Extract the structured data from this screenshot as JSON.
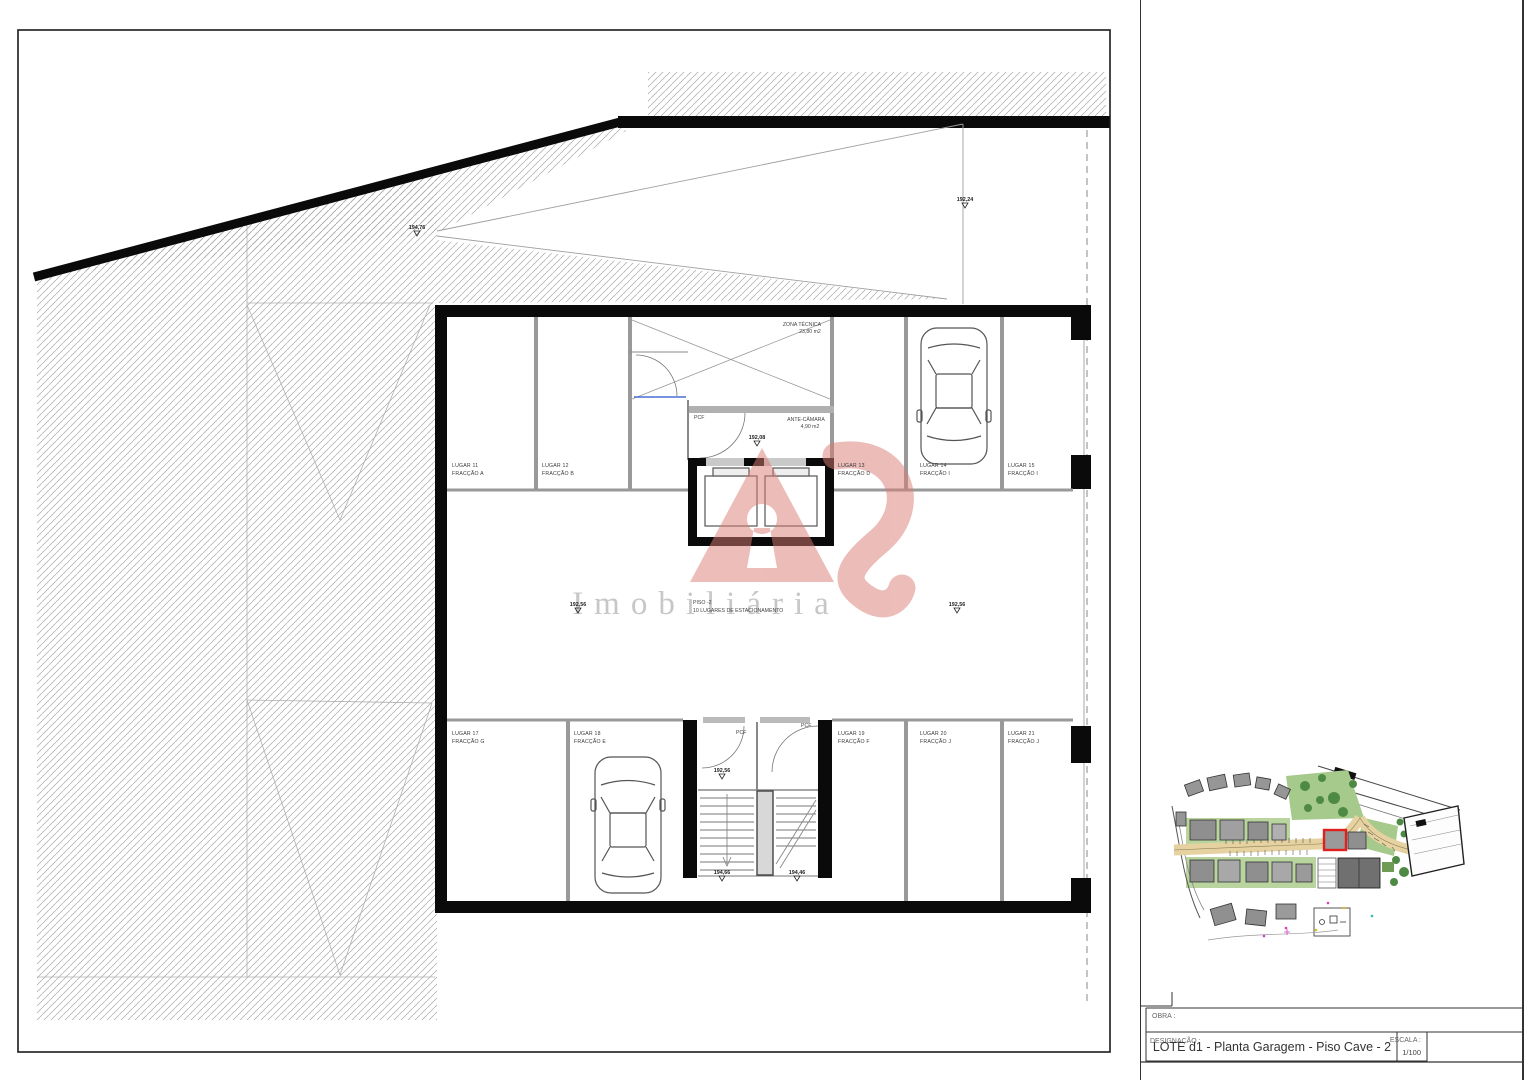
{
  "watermark": {
    "brand": "Imobiliária"
  },
  "plan": {
    "rooms": {
      "zona_tecnica_name": "ZONA TÉCNICA",
      "zona_tecnica_area": "23,80 m2",
      "ante_camara_name": "ANTE-CÂMARA",
      "ante_camara_area": "4,90 m2",
      "piso_label": "PISO -2",
      "piso_sublabel": "10 LUGARES DE ESTACIONAMENTO",
      "door_label": "PCF"
    },
    "stalls_top": [
      {
        "lugar": "LUGAR 11",
        "fraccao": "FRACÇÃO A"
      },
      {
        "lugar": "LUGAR 12",
        "fraccao": "FRACÇÃO B"
      },
      {
        "lugar": "LUGAR 13",
        "fraccao": "FRACÇÃO D"
      },
      {
        "lugar": "LUGAR 14",
        "fraccao": "FRACÇÃO I"
      },
      {
        "lugar": "LUGAR 15",
        "fraccao": "FRACÇÃO I"
      }
    ],
    "stalls_bottom": [
      {
        "lugar": "LUGAR 17",
        "fraccao": "FRACÇÃO G"
      },
      {
        "lugar": "LUGAR 18",
        "fraccao": "FRACÇÃO E"
      },
      {
        "lugar": "LUGAR 19",
        "fraccao": "FRACÇÃO F"
      },
      {
        "lugar": "LUGAR 20",
        "fraccao": "FRACÇÃO J"
      },
      {
        "lugar": "LUGAR 21",
        "fraccao": "FRACÇÃO J"
      }
    ],
    "levels": [
      {
        "id": "ramp-upper-left",
        "value": "194,76"
      },
      {
        "id": "ramp-upper-right",
        "value": "192,24"
      },
      {
        "id": "elevator-lobby",
        "value": "192,08"
      },
      {
        "id": "aisle-west",
        "value": "192,56"
      },
      {
        "id": "aisle-east",
        "value": "192,56"
      },
      {
        "id": "stair-lobby",
        "value": "192,56"
      },
      {
        "id": "stair-flight-left",
        "value": "194,66"
      },
      {
        "id": "stair-flight-right",
        "value": "194,46"
      }
    ]
  },
  "title_block": {
    "obra_label": "OBRA :",
    "designacao_label": "DESIGNAÇÃO :",
    "designacao_value": "LOTE d1 -  Planta Garagem  -  Piso Cave - 2",
    "escala_label": "ESCALA :",
    "escala_value": "1/100"
  },
  "colors": {
    "logo_pink": "#d97b74",
    "highlight_red": "#e02020",
    "wall_black": "#0a0a0a",
    "hatch_gray": "#a8a8a8"
  }
}
